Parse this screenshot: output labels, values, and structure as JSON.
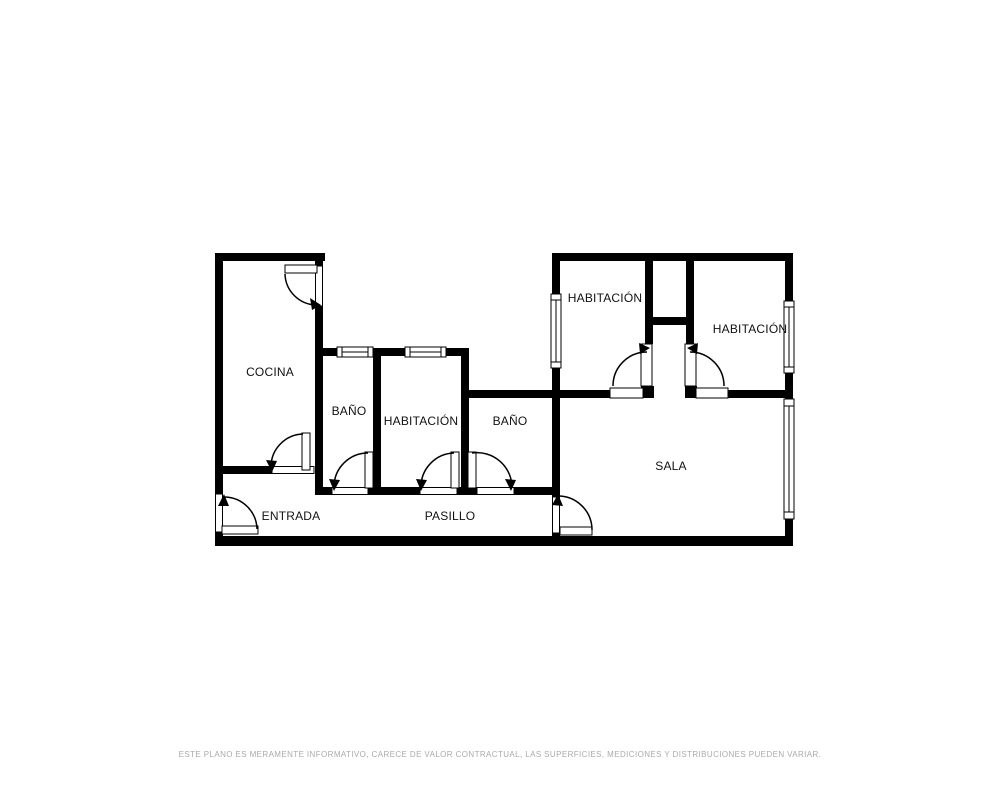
{
  "rooms": {
    "cocina": {
      "label": "COCINA"
    },
    "bano1": {
      "label": "BAÑO"
    },
    "habitacion_media": {
      "label": "HABITACIÓN"
    },
    "bano2": {
      "label": "BAÑO"
    },
    "habitacion_izq": {
      "label": "HABITACIÓN"
    },
    "habitacion_der": {
      "label": "HABITACIÓN"
    },
    "sala": {
      "label": "SALA"
    },
    "entrada": {
      "label": "ENTRADA"
    },
    "pasillo": {
      "label": "PASILLO"
    }
  },
  "footer": {
    "disclaimer": "ESTE PLANO ES MERAMENTE INFORMATIVO, CARECE DE VALOR CONTRACTUAL, LAS SUPERFICIES, MEDICIONES Y DISTRIBUCIONES PUEDEN VARIAR."
  },
  "colors": {
    "wall": "#000000",
    "background": "#ffffff",
    "label_text": "#111111",
    "disclaimer_text": "#aaaaaa"
  }
}
